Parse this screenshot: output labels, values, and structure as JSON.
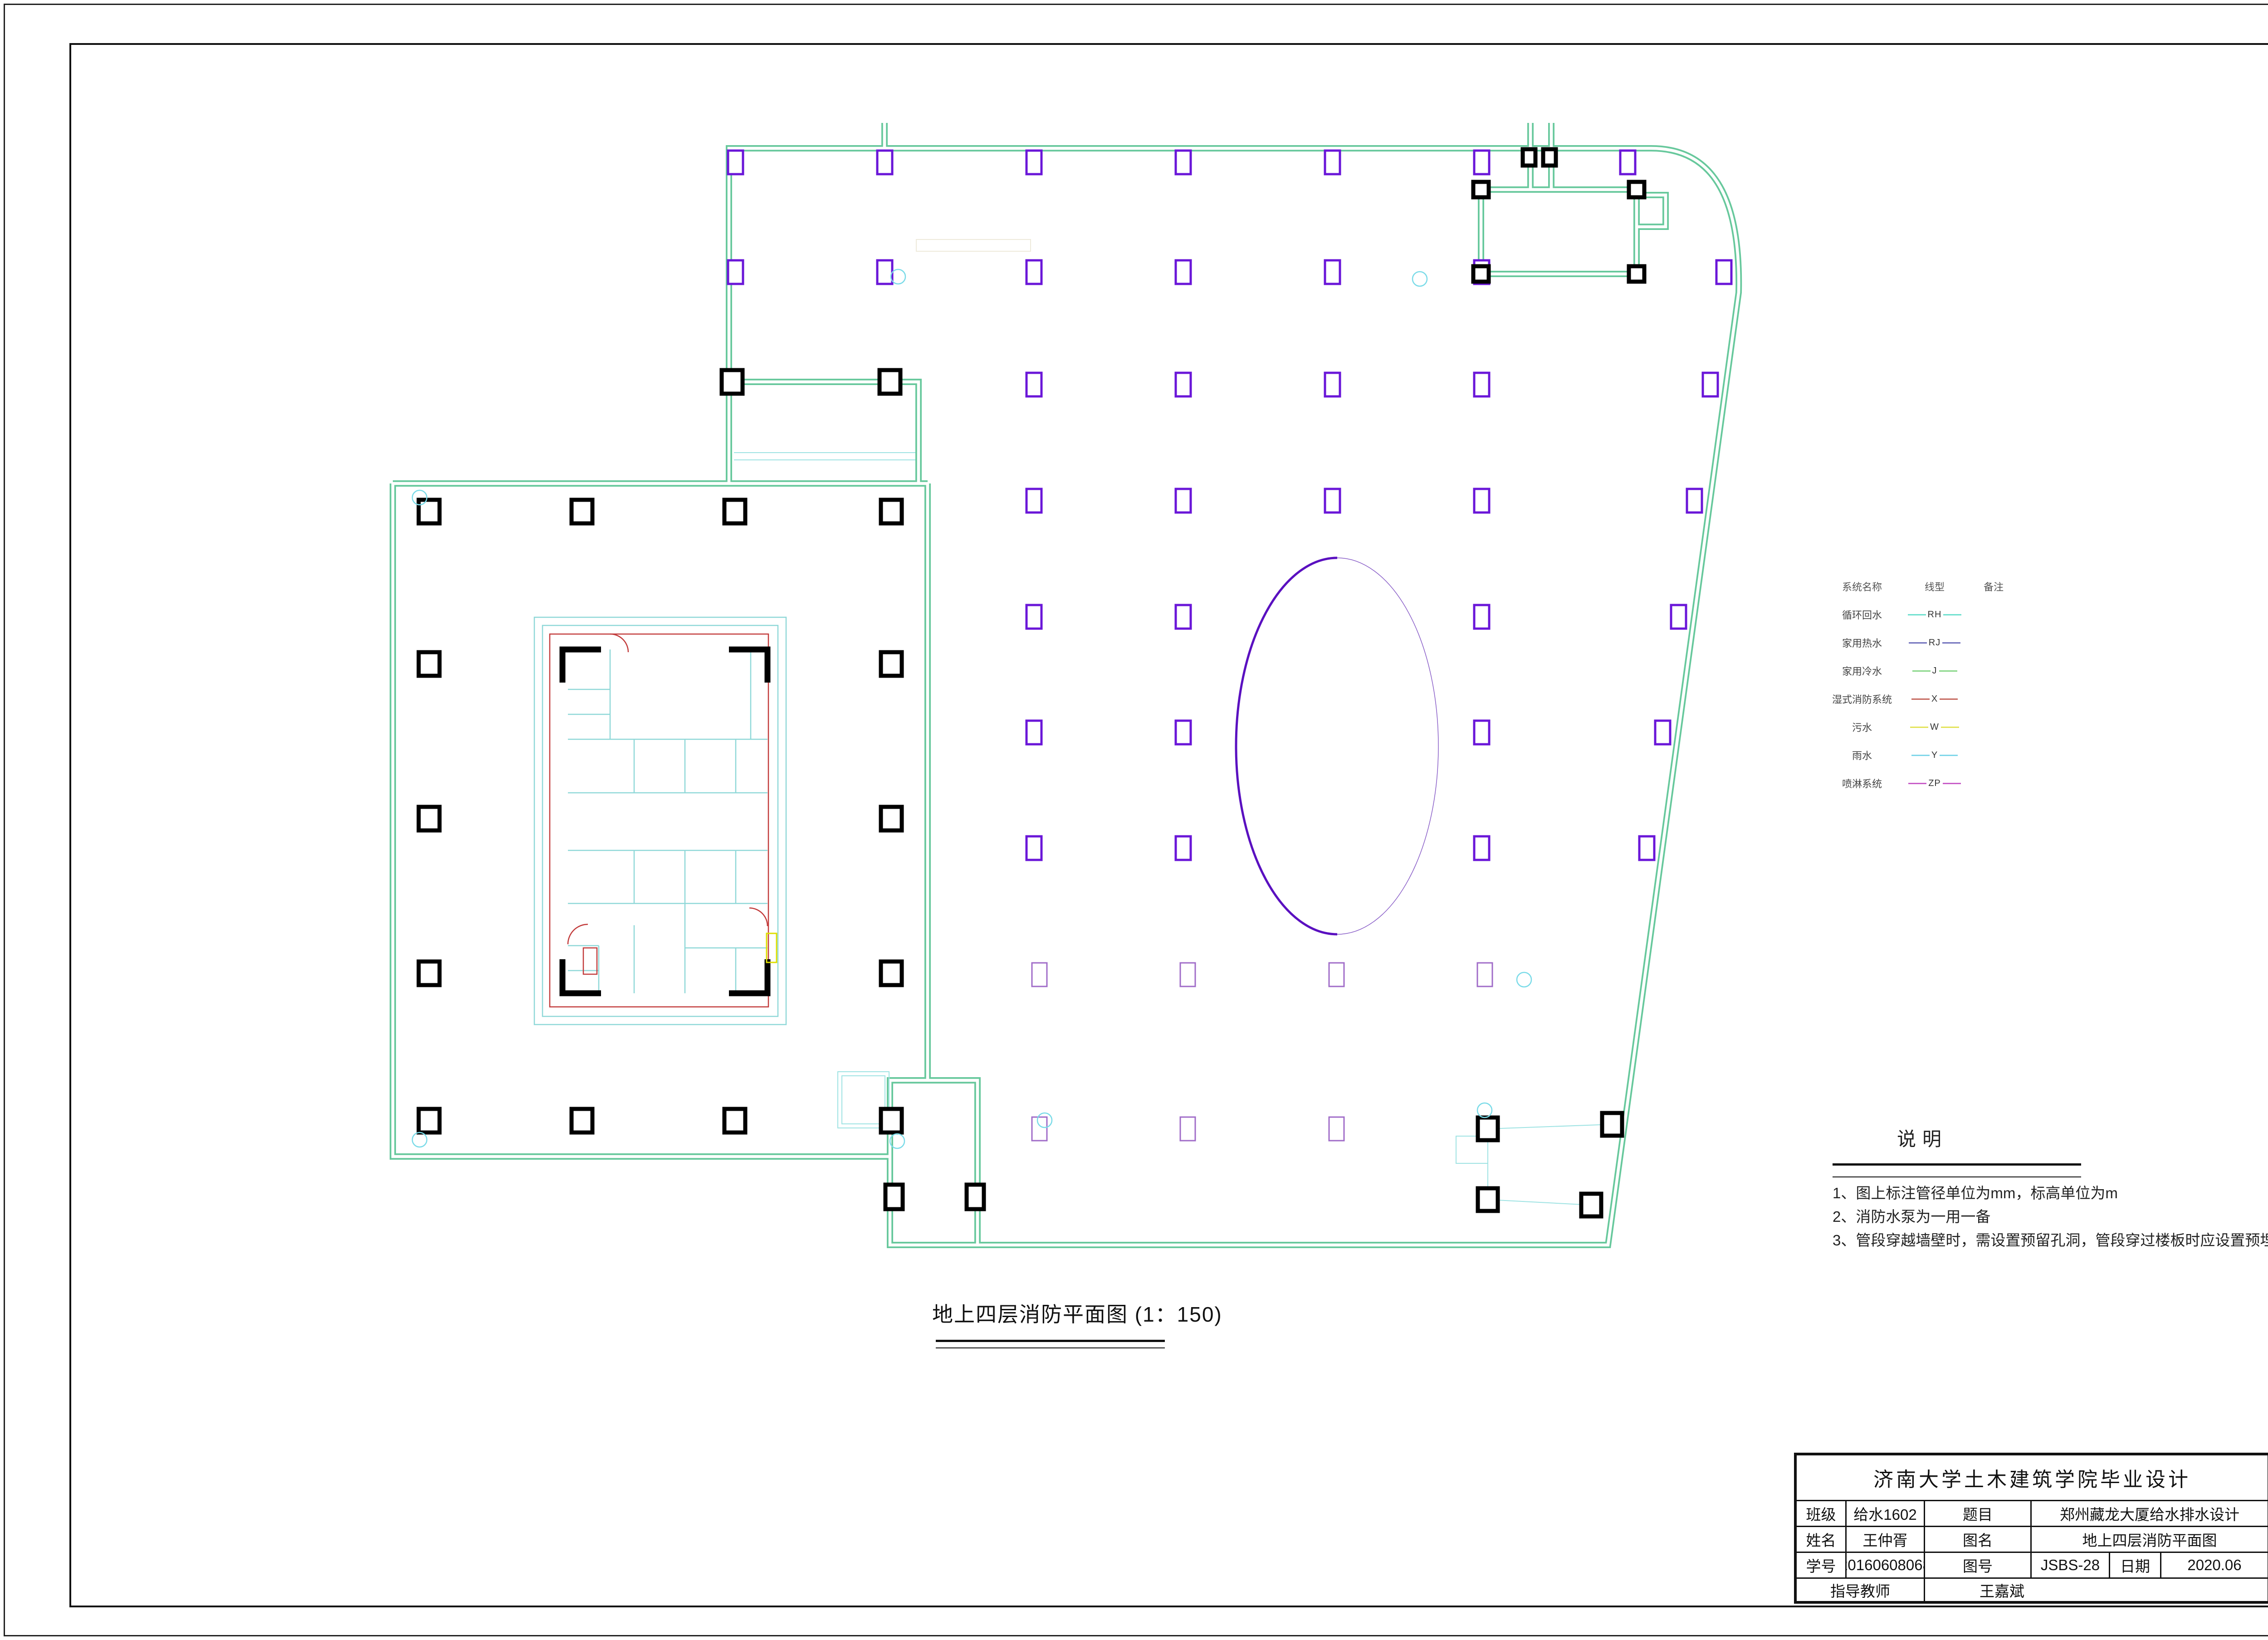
{
  "plan": {
    "caption": "地上四层消防平面图 (1：150)"
  },
  "legend": {
    "headers": [
      "系统名称",
      "线型",
      "备注"
    ],
    "rows": [
      {
        "name": "循环回水",
        "code": "RH",
        "color": "#6fe0cf",
        "remark": ""
      },
      {
        "name": "家用热水",
        "code": "RJ",
        "color": "#7272bd",
        "remark": ""
      },
      {
        "name": "家用冷水",
        "code": "J",
        "color": "#8ad88a",
        "remark": ""
      },
      {
        "name": "湿式消防系统",
        "code": "X",
        "color": "#c66a60",
        "remark": ""
      },
      {
        "name": "污水",
        "code": "W",
        "color": "#e3e35a",
        "remark": ""
      },
      {
        "name": "雨水",
        "code": "Y",
        "color": "#7fd7ea",
        "remark": ""
      },
      {
        "name": "喷淋系统",
        "code": "ZP",
        "color": "#c85fc8",
        "remark": ""
      }
    ]
  },
  "notes": {
    "title": "说明",
    "items": [
      "1、图上标注管径单位为mm，标高单位为m",
      "2、消防水泵为一用一备",
      "3、管段穿越墙壁时，需设置预留孔洞，管段穿过楼板时应设置预埋金属管套"
    ]
  },
  "title_block": {
    "header": "济南大学土木建筑学院毕业设计",
    "class_label": "班级",
    "class_value": "给水1602",
    "topic_label": "题目",
    "topic_value": "郑州藏龙大厦给水排水设计",
    "name_label": "姓名",
    "name_value": "王仲胥",
    "figname_label": "图名",
    "figname_value": "地上四层消防平面图",
    "stuid_label": "学号",
    "stuid_value": "20160608068",
    "figno_label": "图号",
    "figno_value": "JSBS-28",
    "date_label": "日期",
    "date_value": "2020.06",
    "advisor_label": "指导教师",
    "advisor_value": "王嘉斌"
  },
  "colors": {
    "wall_green": "#67c89c",
    "column_purple": "#6a16d8",
    "column_purple_light": "#a06cc8",
    "core_cyan": "#8fd8d8",
    "core_red": "#c23b3b",
    "ellipse_purple": "#5a10c0"
  }
}
